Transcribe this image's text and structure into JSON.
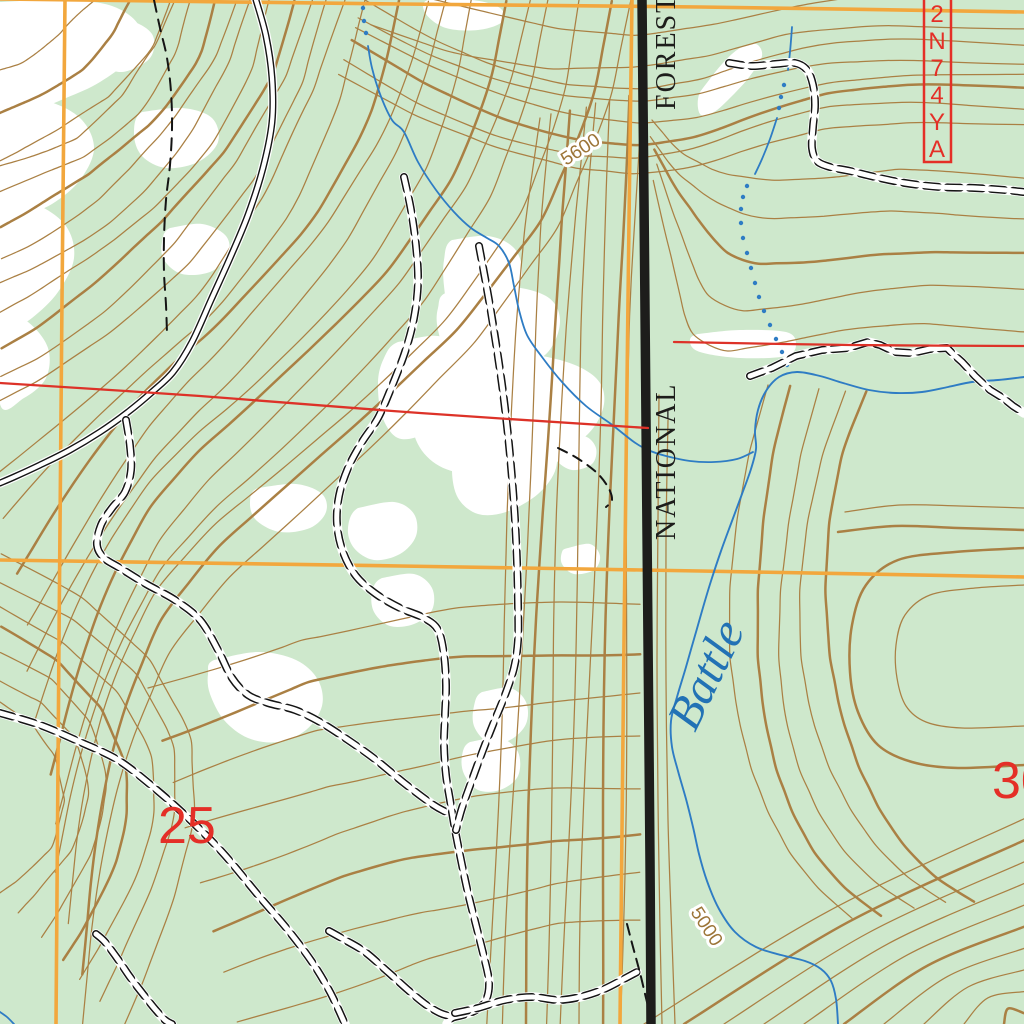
{
  "map_labels": {
    "forest_boundary_upper": "FOREST",
    "forest_boundary_lower": "NATIONAL",
    "creek_name": "Battle",
    "contour_elevation_upper": "5600",
    "contour_elevation_lower": "5000",
    "section_number_left": "25",
    "section_number_right": "30",
    "forest_route": "2N74YA",
    "forest_route_chars": [
      "2",
      "N",
      "7",
      "4",
      "Y",
      "A"
    ]
  },
  "colors": {
    "background_green": "#cee8cc",
    "clearing_white": "#ffffff",
    "contour_brown": "#aa8044",
    "water_blue": "#2e7cc4",
    "water_label_blue": "#2272b5",
    "grid_orange": "#f2a73d",
    "section_line_red": "#dd3228",
    "label_red": "#e42f27",
    "boundary_black": "#1d1d1b",
    "road_black": "#141414",
    "contour_label_brown": "#9c7538"
  }
}
